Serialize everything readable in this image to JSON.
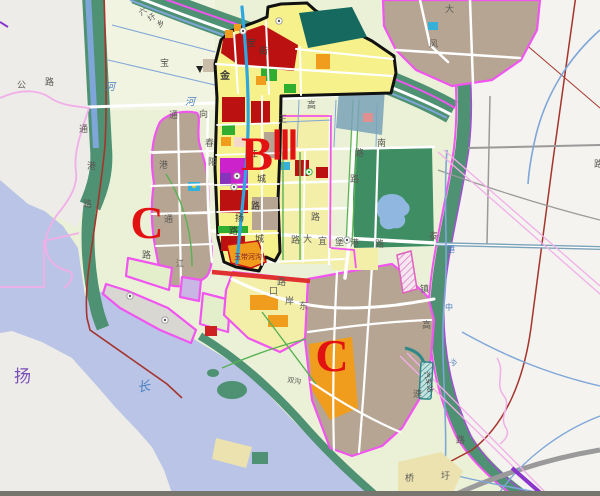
{
  "map": {
    "description": "urban planning zoning map with Yangtze river, district B-III outlined in black, C zones outlined in magenta",
    "palette": {
      "water": "#b9c4e6",
      "land_gray": "#edece8",
      "white_area": "#f4f3ef",
      "field": "#ebf1d6",
      "field_light": "#f2f4e2",
      "green_band": "#4f9173",
      "park_green": "#3f8d63",
      "tan_zone": "#b7a593",
      "district_yellow": "#f7f18b",
      "yellow_zone": "#f3efa8",
      "red_block": "#bb1111",
      "orange_block": "#f09d1e",
      "green_block": "#2fae2f",
      "magenta_block": "#cc22cc",
      "violet_block": "#8833bb",
      "teal_block": "#15695f",
      "cyan_block": "#35b0d8",
      "steel_blue": "#7aa2b8",
      "khaki": "#ebe2b0",
      "boundary_magenta": "#f055f0",
      "pink_line": "#f2aee8",
      "district_outline": "#111111",
      "rail_red": "#a5342c",
      "road_white": "#ffffff",
      "green_road": "#58b154",
      "gray_road": "#9a9a9a",
      "canal_blue": "#2da7e0",
      "river_line": "#7ea6d8",
      "lake_blue": "#8fb7e0",
      "letter_red": "#e31212",
      "label_gray": "#5a5a55",
      "label_dark": "#3c3c38",
      "label_blue": "#4a7ec0",
      "label_purple": "#7a50b8",
      "label_redtext": "#8b2020"
    },
    "zone_letters": [
      {
        "text": "C",
        "x": 147,
        "y": 238,
        "size": 46
      },
      {
        "text": "B",
        "x": 257,
        "y": 170,
        "size": 48
      },
      {
        "text": "Ⅲ",
        "x": 285,
        "y": 159,
        "size": 40
      },
      {
        "text": "C",
        "x": 332,
        "y": 371,
        "size": 46
      }
    ],
    "labels": [
      {
        "t": "公",
        "x": 17,
        "y": 88,
        "s": 9,
        "c": "label_gray"
      },
      {
        "t": "路",
        "x": 45,
        "y": 85,
        "s": 9,
        "c": "label_gray"
      },
      {
        "t": "六",
        "x": 141,
        "y": 16,
        "s": 8,
        "c": "label_gray",
        "r": -35
      },
      {
        "t": "圩",
        "x": 150,
        "y": 22,
        "s": 8,
        "c": "label_gray",
        "r": -35
      },
      {
        "t": "乡",
        "x": 159,
        "y": 28,
        "s": 8,
        "c": "label_gray",
        "r": -35
      },
      {
        "t": "河",
        "x": 105,
        "y": 90,
        "s": 10,
        "c": "label_blue",
        "i": 1
      },
      {
        "t": "宝",
        "x": 160,
        "y": 66,
        "s": 9,
        "c": "label_gray"
      },
      {
        "t": "河",
        "x": 185,
        "y": 105,
        "s": 10,
        "c": "label_blue",
        "i": 1
      },
      {
        "t": "通",
        "x": 79,
        "y": 132,
        "s": 9,
        "c": "label_gray"
      },
      {
        "t": "港",
        "x": 87,
        "y": 169,
        "s": 9,
        "c": "label_gray"
      },
      {
        "t": "路",
        "x": 83,
        "y": 207,
        "s": 9,
        "c": "label_gray"
      },
      {
        "t": "通",
        "x": 169,
        "y": 118,
        "s": 9,
        "c": "label_gray"
      },
      {
        "t": "春",
        "x": 205,
        "y": 146,
        "s": 9,
        "c": "label_gray"
      },
      {
        "t": "阳",
        "x": 208,
        "y": 165,
        "s": 9,
        "c": "label_gray"
      },
      {
        "t": "港",
        "x": 159,
        "y": 168,
        "s": 9,
        "c": "label_gray"
      },
      {
        "t": "通",
        "x": 164,
        "y": 222,
        "s": 9,
        "c": "label_gray"
      },
      {
        "t": "路",
        "x": 142,
        "y": 258,
        "s": 9,
        "c": "label_gray"
      },
      {
        "t": "江",
        "x": 176,
        "y": 266,
        "s": 8,
        "c": "label_gray"
      },
      {
        "t": "金",
        "x": 220,
        "y": 79,
        "s": 10,
        "c": "label_dark",
        "b": 1
      },
      {
        "t": "向",
        "x": 199,
        "y": 117,
        "s": 9,
        "c": "label_gray"
      },
      {
        "t": "宝",
        "x": 247,
        "y": 46,
        "s": 9,
        "c": "label_dark"
      },
      {
        "t": "街",
        "x": 259,
        "y": 54,
        "s": 9,
        "c": "label_dark"
      },
      {
        "t": "高",
        "x": 307,
        "y": 108,
        "s": 9,
        "c": "label_gray"
      },
      {
        "t": "王",
        "x": 278,
        "y": 122,
        "s": 9,
        "c": "label_gray"
      },
      {
        "t": "江",
        "x": 249,
        "y": 157,
        "s": 9,
        "c": "label_dark"
      },
      {
        "t": "城",
        "x": 257,
        "y": 182,
        "s": 9,
        "c": "label_dark"
      },
      {
        "t": "路",
        "x": 251,
        "y": 209,
        "s": 9,
        "c": "label_dark"
      },
      {
        "t": "扬",
        "x": 235,
        "y": 221,
        "s": 9,
        "c": "label_dark"
      },
      {
        "t": "路",
        "x": 229,
        "y": 234,
        "s": 9,
        "c": "label_dark"
      },
      {
        "t": "城",
        "x": 255,
        "y": 242,
        "s": 9,
        "c": "label_dark"
      },
      {
        "t": "玉带河沟",
        "x": 234,
        "y": 259,
        "s": 7,
        "c": "label_redtext"
      },
      {
        "t": "南",
        "x": 377,
        "y": 146,
        "s": 9,
        "c": "label_gray"
      },
      {
        "t": "路",
        "x": 355,
        "y": 156,
        "s": 9,
        "c": "label_gray"
      },
      {
        "t": "路",
        "x": 350,
        "y": 182,
        "s": 9,
        "c": "label_gray"
      },
      {
        "t": "路",
        "x": 311,
        "y": 220,
        "s": 9,
        "c": "label_gray"
      },
      {
        "t": "路",
        "x": 291,
        "y": 243,
        "s": 9,
        "c": "label_gray"
      },
      {
        "t": "大",
        "x": 303,
        "y": 242,
        "s": 9,
        "c": "label_gray"
      },
      {
        "t": "宜",
        "x": 318,
        "y": 244,
        "s": 9,
        "c": "label_gray"
      },
      {
        "t": "堡",
        "x": 335,
        "y": 245,
        "s": 9,
        "c": "label_gray"
      },
      {
        "t": "港",
        "x": 350,
        "y": 246,
        "s": 9,
        "c": "label_gray"
      },
      {
        "t": "路",
        "x": 375,
        "y": 247,
        "s": 9,
        "c": "label_gray"
      },
      {
        "t": "口",
        "x": 269,
        "y": 294,
        "s": 9,
        "c": "label_gray"
      },
      {
        "t": "岸",
        "x": 285,
        "y": 304,
        "s": 9,
        "c": "label_gray"
      },
      {
        "t": "东",
        "x": 299,
        "y": 309,
        "s": 9,
        "c": "label_gray"
      },
      {
        "t": "路",
        "x": 277,
        "y": 285,
        "s": 9,
        "c": "label_gray"
      },
      {
        "t": "泰",
        "x": 429,
        "y": 239,
        "s": 9,
        "c": "label_gray"
      },
      {
        "t": "镇",
        "x": 420,
        "y": 292,
        "s": 9,
        "c": "label_gray"
      },
      {
        "t": "高",
        "x": 422,
        "y": 328,
        "s": 9,
        "c": "label_gray"
      },
      {
        "t": "速",
        "x": 413,
        "y": 397,
        "s": 9,
        "c": "label_gray"
      },
      {
        "t": "中",
        "x": 445,
        "y": 310,
        "s": 8,
        "c": "label_blue"
      },
      {
        "t": "港",
        "x": 447,
        "y": 252,
        "s": 8,
        "c": "label_blue"
      },
      {
        "t": "沟",
        "x": 449,
        "y": 362,
        "s": 7,
        "c": "label_blue",
        "r": 40
      },
      {
        "t": "汽车站",
        "x": 424,
        "y": 372,
        "s": 7,
        "c": "label_dark",
        "r": 78
      },
      {
        "t": "桥",
        "x": 405,
        "y": 481,
        "s": 9,
        "c": "label_gray"
      },
      {
        "t": "圩",
        "x": 441,
        "y": 479,
        "s": 9,
        "c": "label_gray"
      },
      {
        "t": "路",
        "x": 456,
        "y": 443,
        "s": 9,
        "c": "label_gray"
      },
      {
        "t": "双沟",
        "x": 287,
        "y": 382,
        "s": 7,
        "c": "label_gray",
        "r": 8
      },
      {
        "t": "大",
        "x": 445,
        "y": 12,
        "s": 9,
        "c": "label_gray"
      },
      {
        "t": "风",
        "x": 429,
        "y": 47,
        "s": 9,
        "c": "label_gray"
      },
      {
        "t": "路",
        "x": 594,
        "y": 167,
        "s": 9,
        "c": "label_gray"
      },
      {
        "t": "扬",
        "x": 14,
        "y": 382,
        "s": 17,
        "c": "label_purple"
      },
      {
        "t": "长",
        "x": 138,
        "y": 392,
        "s": 13,
        "c": "label_blue",
        "i": 1,
        "r": -10
      }
    ]
  }
}
